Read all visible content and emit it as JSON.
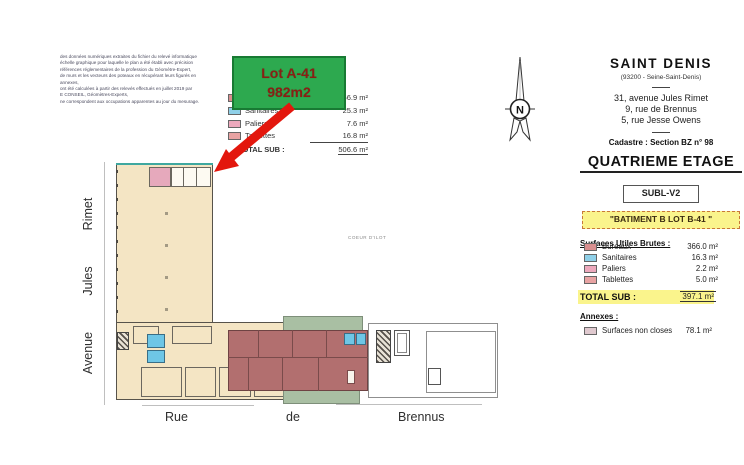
{
  "fine_print": {
    "lines": [
      "des données numériques extraites du fichier du relevé informatique",
      "échelle graphique pour laquelle le plan a été établi avec précision",
      "références réglementaires de la profession du Géomètre-Expert,",
      "de murs et les vecteurs des poteaux en récupérant leurs figurés en",
      "annexes,",
      "ont été calculées à partir des relevés effectués en juillet 2019 par",
      "E CONSEIL, Géomètres-Experts,",
      "ne correspondent aux occupations apparentes au jour du mesurage."
    ]
  },
  "callout": {
    "title": "Lot A-41",
    "area": "982m2"
  },
  "left_legend": {
    "rows": [
      {
        "label": "Bureaux",
        "value": "456.9 m²",
        "color": "#d98f8f"
      },
      {
        "label": "Sanitaires",
        "value": "25.3 m²",
        "color": "#8fd0e8"
      },
      {
        "label": "Paliers",
        "value": "7.6 m²",
        "color": "#eda9bd"
      },
      {
        "label": "Tablettes",
        "value": "16.8 m²",
        "color": "#e8a3a3"
      }
    ],
    "total_label": "TOTAL SUB :",
    "total_value": "506.6 m²"
  },
  "compass": {
    "letter": "N"
  },
  "panel": {
    "city": "SAINT DENIS",
    "dept": "(93200 - Seine-Saint-Denis)",
    "addresses": [
      "31, avenue Jules Rimet",
      "9, rue de Brennus",
      "5, rue Jesse Owens"
    ],
    "cadastre": "Cadastre : Section BZ n° 98",
    "floor": "QUATRIEME ETAGE",
    "version": "SUBL-V2",
    "batiment": "\"BATIMENT B LOT B-41 \"",
    "sub_title": "Surfaces Utiles Brutes :",
    "rows": [
      {
        "label": "Bureaux",
        "value": "366.0 m²",
        "color": "#d98f8f"
      },
      {
        "label": "Sanitaires",
        "value": "16.3 m²",
        "color": "#8fd0e8"
      },
      {
        "label": "Paliers",
        "value": "2.2 m²",
        "color": "#eda9bd"
      },
      {
        "label": "Tablettes",
        "value": "5.0 m²",
        "color": "#e8a3a3"
      }
    ],
    "total_label": "TOTAL SUB :",
    "total_value": "397.1 m²",
    "annex_title": "Annexes :",
    "annex_row": {
      "label": "Surfaces non closes",
      "value": "78.1 m²",
      "color": "#e0c9cf"
    }
  },
  "plan": {
    "street_left": [
      "Rimet",
      "Jules",
      "Avenue"
    ],
    "street_bottom": [
      "Rue",
      "de",
      "Brennus"
    ],
    "center_label": "COEUR D'ILOT"
  },
  "colors": {
    "callout_green": "#2da94f",
    "arrow_red": "#e3170d",
    "highlight_yellow": "#faf48c",
    "plan_beige": "#f4e5c4",
    "plan_red": "#b26f6f",
    "plan_green": "#a9bfa3",
    "plan_blue": "#6ec6e6",
    "plan_pink": "#e6a9bc"
  }
}
